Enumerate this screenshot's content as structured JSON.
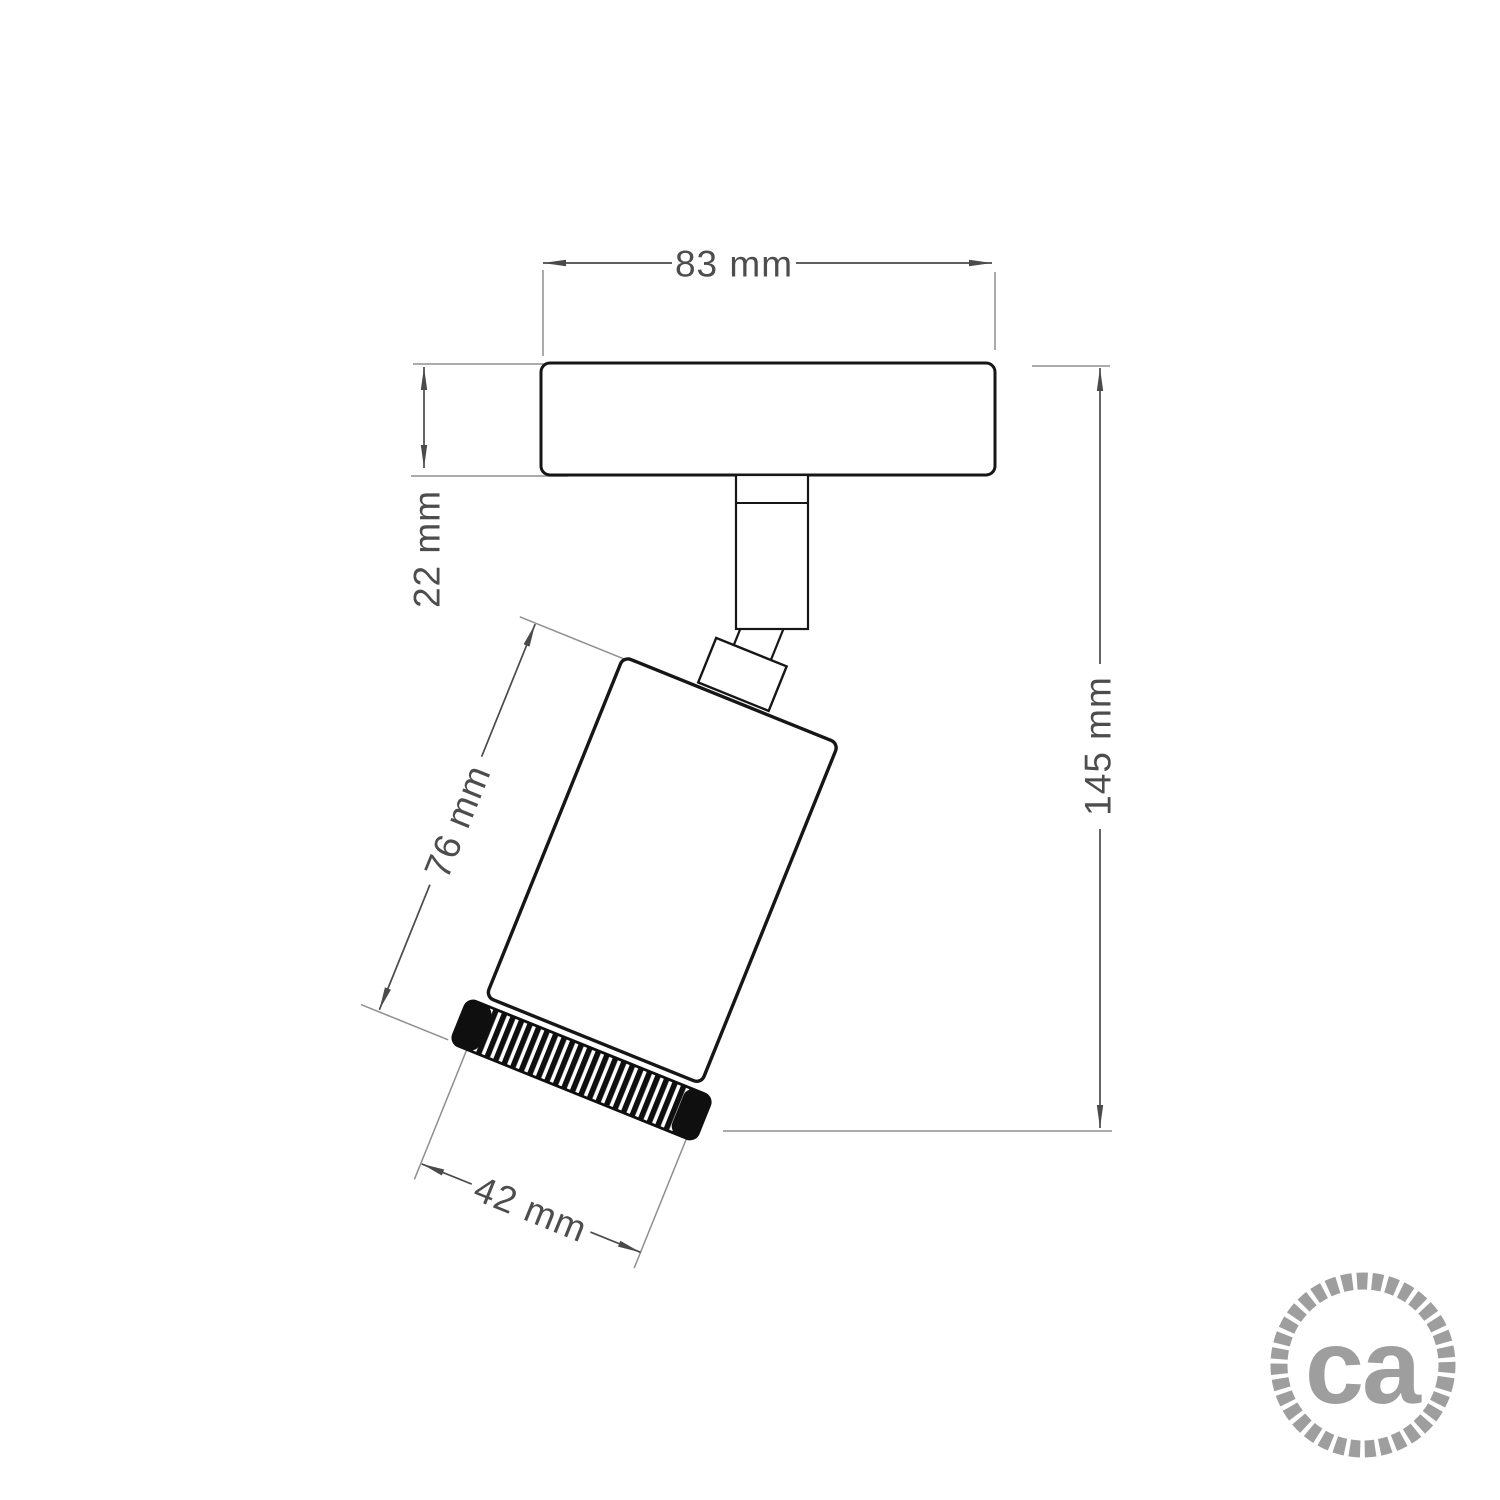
{
  "diagram": {
    "type": "technical-dimension-drawing",
    "subject": "adjustable ceiling spotlight",
    "labels": {
      "plate_width": "83 mm",
      "plate_thickness": "22 mm",
      "body_length": "76 mm",
      "overall_height": "145 mm",
      "body_diameter": "42 mm"
    },
    "colors": {
      "background": "#ffffff",
      "object_outline": "#161616",
      "dimension_line": "#4a4a4a",
      "extension_line": "#8f8f8f",
      "label_text": "#4d4d4d",
      "logo_gray": "#9e9e9e"
    },
    "logo": {
      "text": "ca"
    }
  }
}
